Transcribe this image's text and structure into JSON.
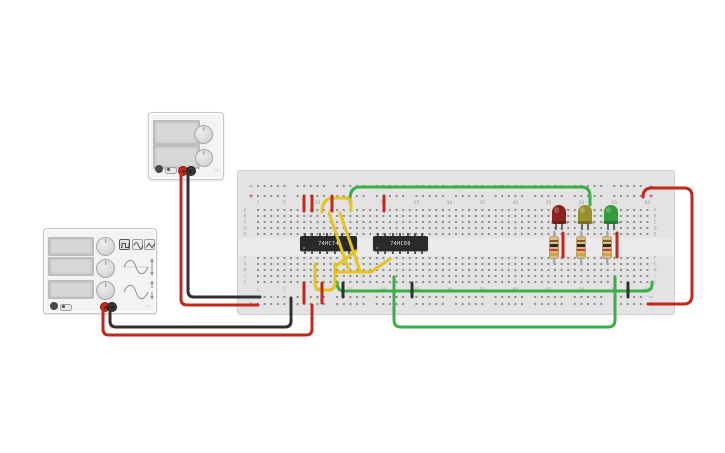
{
  "breadboard": {
    "column_labels": [
      "1",
      "5",
      "10",
      "15",
      "20",
      "25",
      "30",
      "35",
      "40",
      "45",
      "50",
      "55",
      "60"
    ],
    "row_labels_upper": [
      "A",
      "B",
      "C",
      "D",
      "E"
    ],
    "row_labels_lower": [
      "F",
      "G",
      "H",
      "I",
      "J"
    ],
    "rail_negative_symbol": "−",
    "rail_positive_symbol": "+",
    "rail_negative_color": "#5d8fc9",
    "rail_positive_color": "#c3281c",
    "body_color": "#e3e3e3",
    "hole_color": "#8b8b8b",
    "label_color": "#9b9b9b"
  },
  "ics": [
    {
      "label": "74HC74"
    },
    {
      "label": "74HC08"
    }
  ],
  "leds": [
    {
      "color_name": "red",
      "body": "#8e2420"
    },
    {
      "color_name": "yellow",
      "body": "#99902c"
    },
    {
      "color_name": "green",
      "body": "#339b38"
    }
  ],
  "resistors": [
    {
      "bands": [
        "#8a5a2b",
        "#2b2b2b",
        "#cf3a2a",
        "#c9a84c"
      ]
    },
    {
      "bands": [
        "#8a5a2b",
        "#2b2b2b",
        "#cf3a2a",
        "#c9a84c"
      ]
    },
    {
      "bands": [
        "#8a5a2b",
        "#2b2b2b",
        "#cf3a2a",
        "#c9a84c"
      ]
    }
  ],
  "power_supply": {
    "displays": [
      "",
      ""
    ],
    "terminals": [
      {
        "polarity": "positive",
        "color": "#c3281c"
      },
      {
        "polarity": "negative",
        "color": "#3a3a3a"
      }
    ]
  },
  "function_generator": {
    "displays": [
      "",
      "",
      ""
    ],
    "waveform_buttons": [
      {
        "icon": "square-wave",
        "selected": true
      },
      {
        "icon": "sine-wave",
        "selected": false
      },
      {
        "icon": "triangle-wave",
        "selected": false
      }
    ],
    "terminals": [
      {
        "polarity": "positive",
        "color": "#c3281c"
      },
      {
        "polarity": "negative",
        "color": "#3a3a3a"
      }
    ]
  },
  "wires": [
    {
      "id": "ps-positive",
      "color": "#c3281c",
      "d": "M181,170 L181,299 Q181,305 187,305 L258,305"
    },
    {
      "id": "ps-negative",
      "color": "#313131",
      "d": "M188,170 L188,291 Q188,297 194,297 L260,297"
    },
    {
      "id": "fg-positive",
      "color": "#c3281c",
      "d": "M103,307 L103,329 Q103,335 109,335 L306,335 Q312,335 312,329 L312,305"
    },
    {
      "id": "fg-negative",
      "color": "#313131",
      "d": "M110,307 L110,321 Q110,327 116,327 L285,327 Q291,327 291,321 L291,298"
    },
    {
      "id": "rail-bridge-right",
      "color": "#c3281c",
      "d": "M643,197 Q643,188 652,188 L684,188 Q692,188 692,196 L692,295 Q692,304 684,304 L648,304"
    },
    {
      "id": "green-top-run",
      "color": "#3cae47",
      "d": "M350,199 Q350,187 360,187 L581,187 Q590,187 590,196 L590,205"
    },
    {
      "id": "green-bottom-loop",
      "color": "#3cae47",
      "d": "M394,277 L394,320 Q394,327 401,327 L608,327 Q615,327 615,320 L615,277"
    },
    {
      "id": "green-rail-run",
      "color": "#3cae47",
      "d": "M337,282 Q337,291 344,291 L645,291 Q652,291 652,284 L652,282"
    },
    {
      "id": "yellow-a",
      "color": "#e5c321",
      "d": "M322,212 Q322,198 334,198 L345,198 Q351,198 351,204 L351,211"
    },
    {
      "id": "yellow-b",
      "color": "#e5c321",
      "d": "M329,213 L348,268"
    },
    {
      "id": "yellow-c",
      "color": "#e5c321",
      "d": "M340,213 L360,271"
    },
    {
      "id": "yellow-d",
      "color": "#e5c321",
      "d": "M315,264 L315,283 Q315,290 321,290 L329,290 Q335,290 335,283 L335,264"
    },
    {
      "id": "yellow-e",
      "color": "#e5c321",
      "d": "M335,272 L371,272 L390,259"
    },
    {
      "id": "yellow-f",
      "color": "#e5c321",
      "d": "M336,266 L356,251"
    },
    {
      "id": "red-jumper-1",
      "color": "#c3281c",
      "d": "M304,196 L304,211"
    },
    {
      "id": "red-jumper-2",
      "color": "#c3281c",
      "d": "M312,196 L312,211"
    },
    {
      "id": "red-jumper-3",
      "color": "#c3281c",
      "d": "M332,196 L332,211"
    },
    {
      "id": "red-jumper-4",
      "color": "#c3281c",
      "d": "M384,196 L384,211"
    },
    {
      "id": "red-jumper-5",
      "color": "#c3281c",
      "d": "M304,283 L304,303"
    },
    {
      "id": "red-jumper-6",
      "color": "#c3281c",
      "d": "M322,283 L322,303"
    },
    {
      "id": "red-jumper-7",
      "color": "#c3281c",
      "d": "M563,233 L563,257"
    },
    {
      "id": "red-jumper-8",
      "color": "#c3281c",
      "d": "M617,233 L617,257"
    },
    {
      "id": "black-jumper-1",
      "color": "#313131",
      "d": "M343,283 L343,297"
    },
    {
      "id": "black-jumper-2",
      "color": "#313131",
      "d": "M412,283 L412,297"
    },
    {
      "id": "black-jumper-3",
      "color": "#313131",
      "d": "M628,283 L628,297"
    }
  ]
}
